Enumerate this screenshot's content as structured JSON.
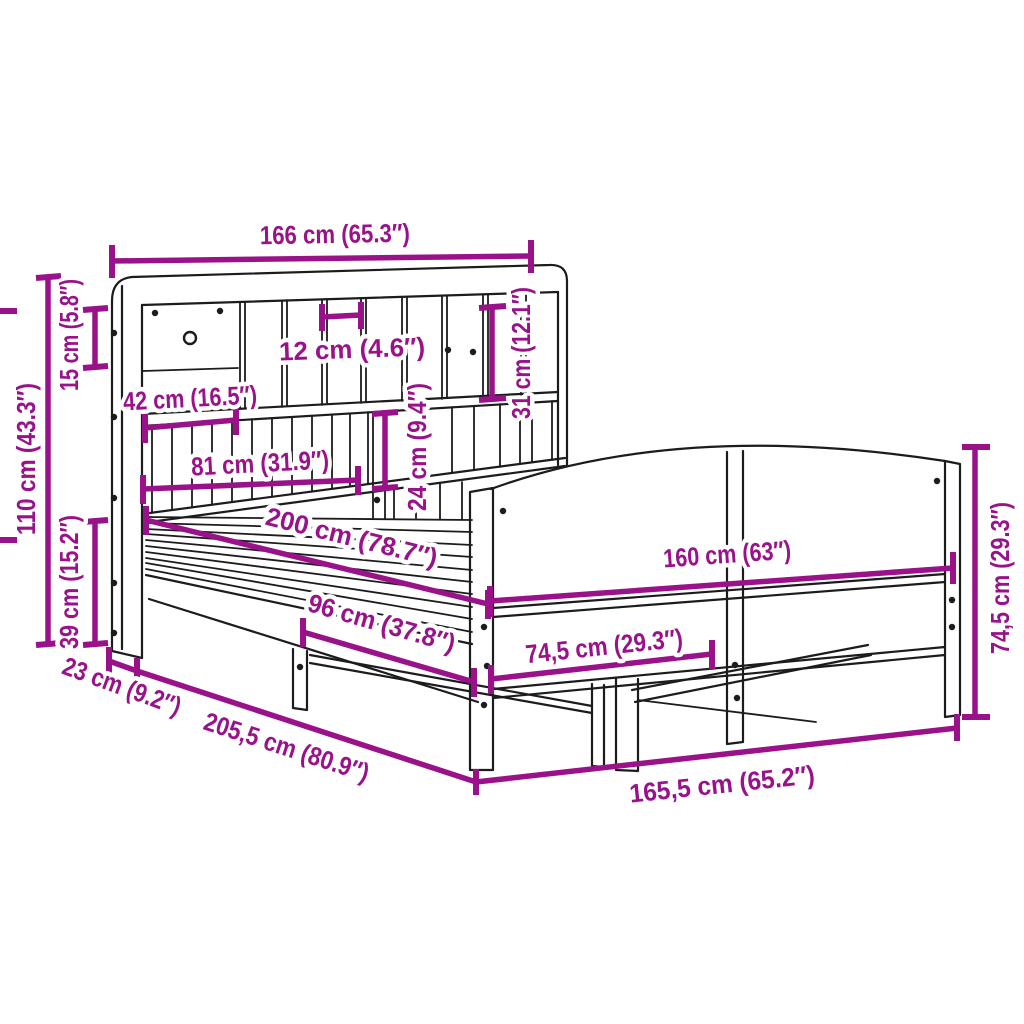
{
  "colors": {
    "accent": "#9A1289",
    "line": "#1c1c1c",
    "background": "#ffffff"
  },
  "measurements": {
    "headboard_width": "166 cm (65.3″)",
    "headboard_top_section_height": "15 cm (5.8″)",
    "headboard_total_height": "110 cm (43.3″)",
    "headboard_lower_height": "39 cm (15.2″)",
    "headboard_depth": "23 cm (9.2″)",
    "cubby_width": "12 cm (4.6″)",
    "shelf_span_42": "42 cm (16.5″)",
    "shelf_span_81": "81 cm (31.9″)",
    "cubby_height_31": "31 cm (12.1″)",
    "cubby_height_24": "24 cm (9.4″)",
    "mattress_length": "200 cm (78.7″)",
    "mattress_width_96": "96 cm (37.8″)",
    "footboard_panel_width": "74,5 cm (29.3″)",
    "footboard_width": "160 cm (63″)",
    "footboard_height": "74,5 cm (29.3″)",
    "frame_total_length": "205,5 cm (80.9″)",
    "frame_total_width": "165,5 cm (65.2″)"
  }
}
